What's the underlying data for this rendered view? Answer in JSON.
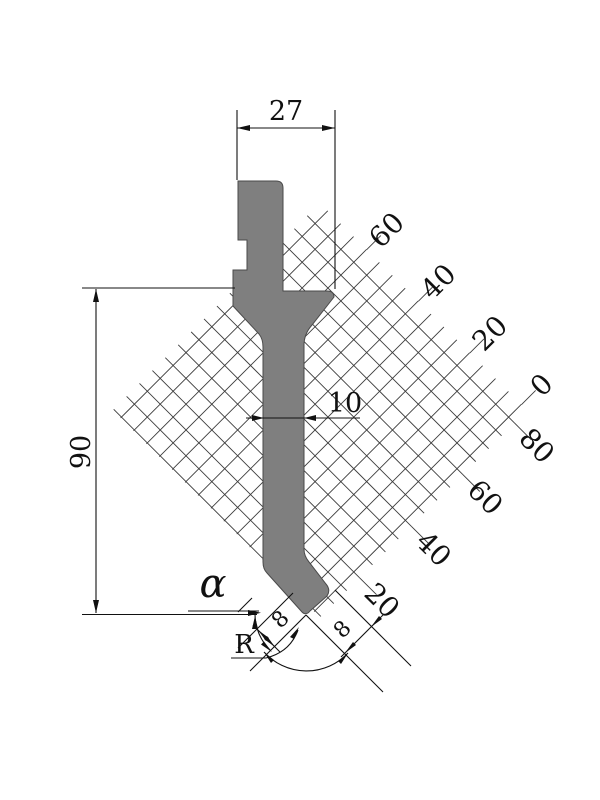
{
  "drawing": {
    "title": "press-brake-punch-profile",
    "dims": {
      "width": "27",
      "height": "90",
      "stem_width": "10",
      "tip_angle": "α",
      "tip_radius": "R",
      "offset_left": "8",
      "offset_right": "8"
    },
    "ruler_ne": [
      "60",
      "40",
      "20",
      "0"
    ],
    "ruler_se": [
      "80",
      "60",
      "40",
      "20"
    ],
    "grid": {
      "cells": 16,
      "cell_step": 18.25,
      "side": 293,
      "offset_ne": 11,
      "offset_se": 18
    },
    "colors": {
      "punch_fill": "#7f7f7f",
      "punch_stroke": "#4a4a4a",
      "line": "#111111",
      "hatch": "#3c3c3c"
    }
  }
}
